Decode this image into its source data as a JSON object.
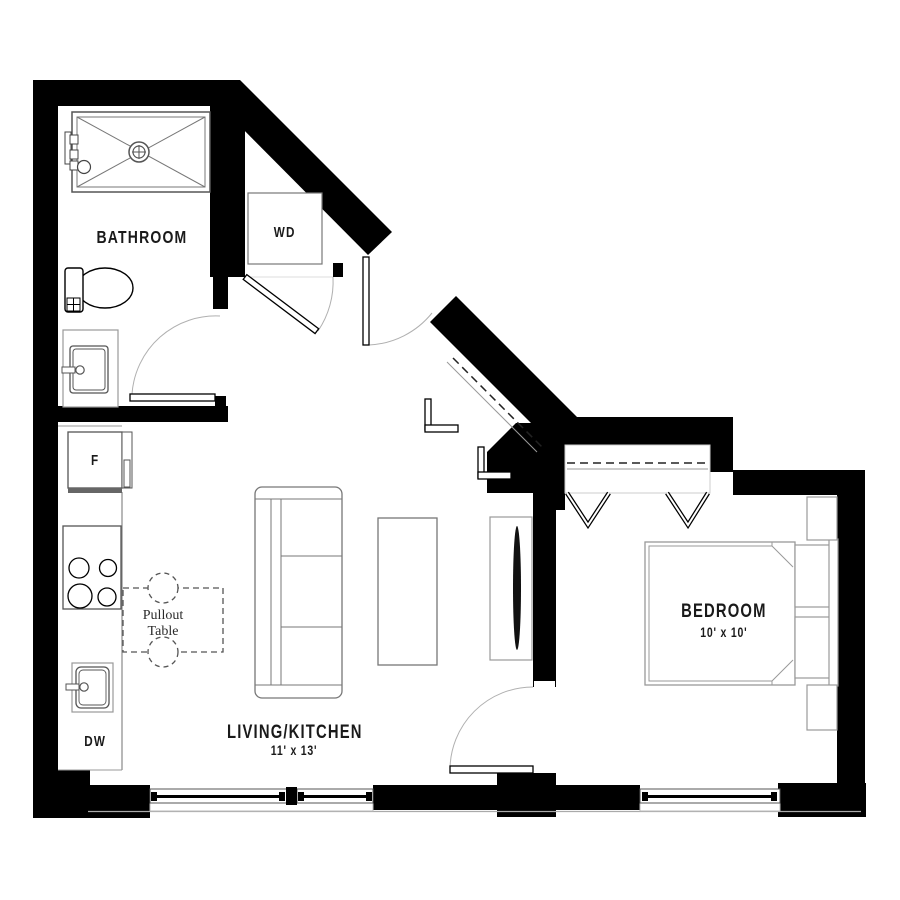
{
  "plan": {
    "type": "apartment-floor-plan",
    "labels": {
      "bathroom": "BATHROOM",
      "washer_dryer": "WD",
      "fridge": "F",
      "dishwasher": "DW",
      "pullout_line1": "Pullout",
      "pullout_line2": "Table",
      "living_kitchen": "LIVING/KITCHEN",
      "living_kitchen_dims": "11' x 13'",
      "bedroom": "BEDROOM",
      "bedroom_dims": "10' x 10'"
    },
    "rooms": [
      {
        "name": "Bathroom"
      },
      {
        "name": "WD closet"
      },
      {
        "name": "Living/Kitchen",
        "dimensions": "11' x 13'"
      },
      {
        "name": "Bedroom",
        "dimensions": "10' x 10'"
      }
    ],
    "colors": {
      "wall": "#000000",
      "background": "#ffffff",
      "fixture_line": "#555555",
      "furniture_line": "#888888",
      "swing_arc": "#b0b0b0",
      "text": "#1a1a1a"
    }
  }
}
